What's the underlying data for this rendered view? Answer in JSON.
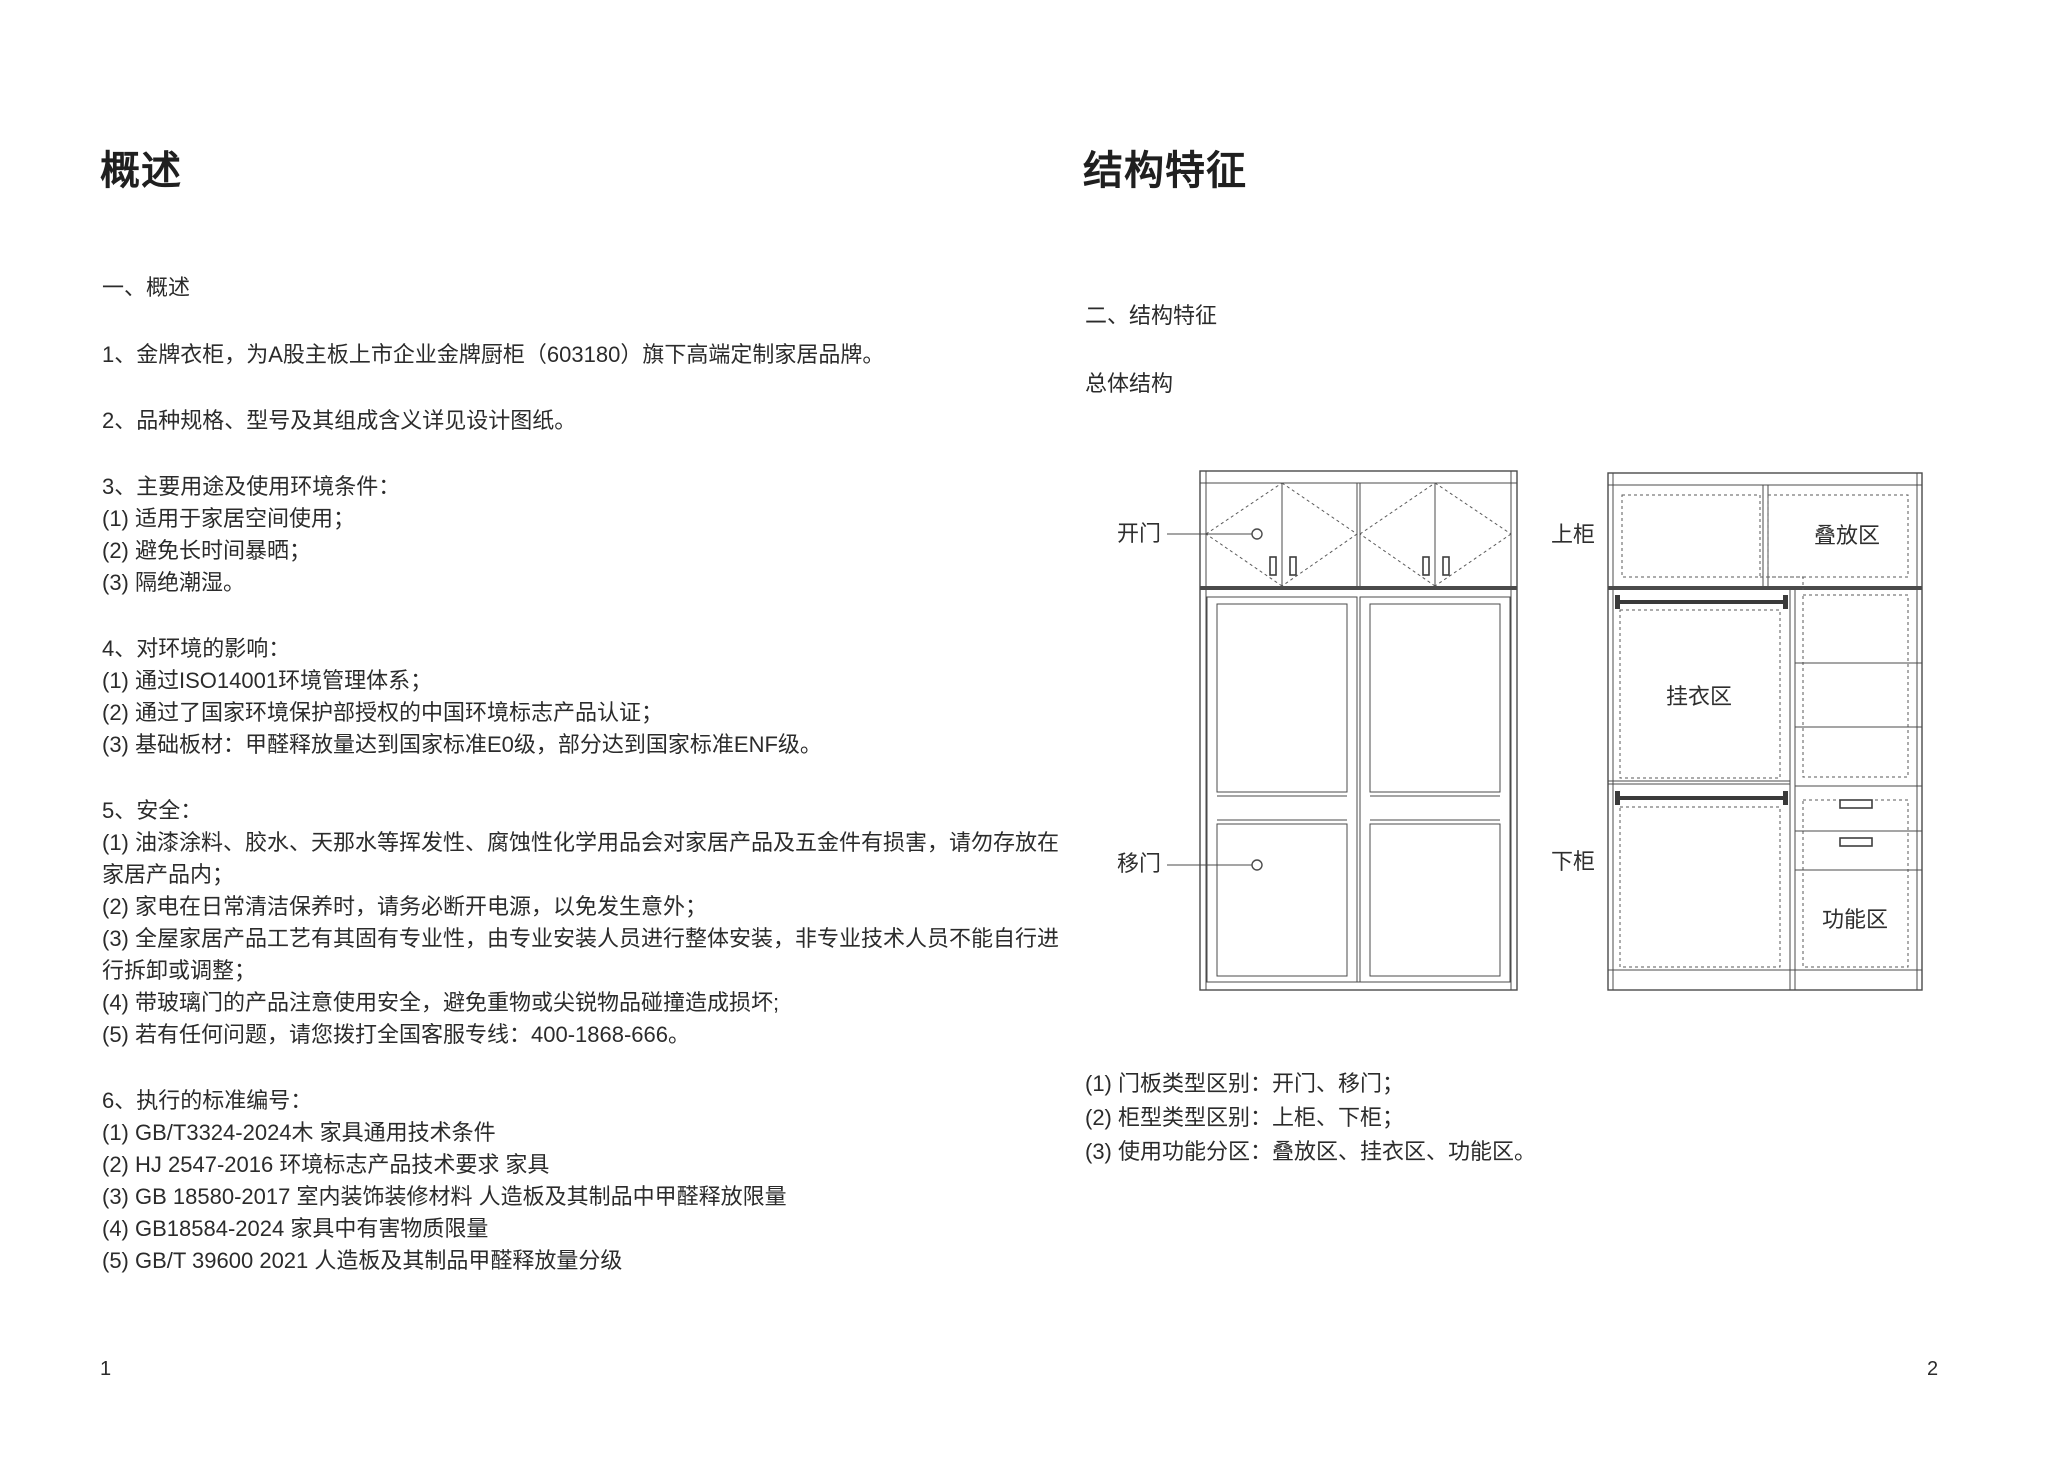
{
  "left_page": {
    "title": "概述",
    "section_heading": "一、概述",
    "lines": [
      "1、金牌衣柜，为A股主板上市企业金牌厨柜（603180）旗下高端定制家居品牌。",
      "2、品种规格、型号及其组成含义详见设计图纸。",
      "3、主要用途及使用环境条件：",
      "(1) 适用于家居空间使用；",
      "(2) 避免长时间暴晒；",
      "(3) 隔绝潮湿。",
      "4、对环境的影响：",
      "(1) 通过ISO14001环境管理体系；",
      "(2) 通过了国家环境保护部授权的中国环境标志产品认证；",
      "(3) 基础板材：甲醛释放量达到国家标准E0级，部分达到国家标准ENF级。",
      "5、安全：",
      "(1) 油漆涂料、胶水、天那水等挥发性、腐蚀性化学用品会对家居产品及五金件有损害，请勿存放在",
      "家居产品内；",
      "(2) 家电在日常清洁保养时，请务必断开电源，以免发生意外；",
      "(3) 全屋家居产品工艺有其固有专业性，由专业安装人员进行整体安装，非专业技术人员不能自行进",
      "行拆卸或调整；",
      "(4) 带玻璃门的产品注意使用安全，避免重物或尖锐物品碰撞造成损坏;",
      "(5) 若有任何问题，请您拨打全国客服专线：400-1868-666。",
      "6、执行的标准编号：",
      "(1) GB/T3324-2024木 家具通用技术条件",
      "(2) HJ 2547-2016 环境标志产品技术要求 家具",
      "(3) GB 18580-2017 室内装饰装修材料 人造板及其制品中甲醛释放限量",
      "(4) GB18584-2024 家具中有害物质限量",
      "(5) GB/T 39600 2021 人造板及其制品甲醛释放量分级"
    ],
    "page_number": "1"
  },
  "right_page": {
    "title": "结构特征",
    "section_heading": "二、结构特征",
    "subsection_heading": "总体结构",
    "diagram_labels": {
      "open_door": "开门",
      "sliding_door": "移门",
      "upper_cabinet": "上柜",
      "lower_cabinet": "下柜",
      "stacking_zone": "叠放区",
      "hanging_zone": "挂衣区",
      "function_zone": "功能区"
    },
    "notes": [
      "(1) 门板类型区别：开门、移门；",
      "(2) 柜型类型区别：上柜、下柜；",
      "(3) 使用功能分区：叠放区、挂衣区、功能区。"
    ],
    "page_number": "2"
  }
}
